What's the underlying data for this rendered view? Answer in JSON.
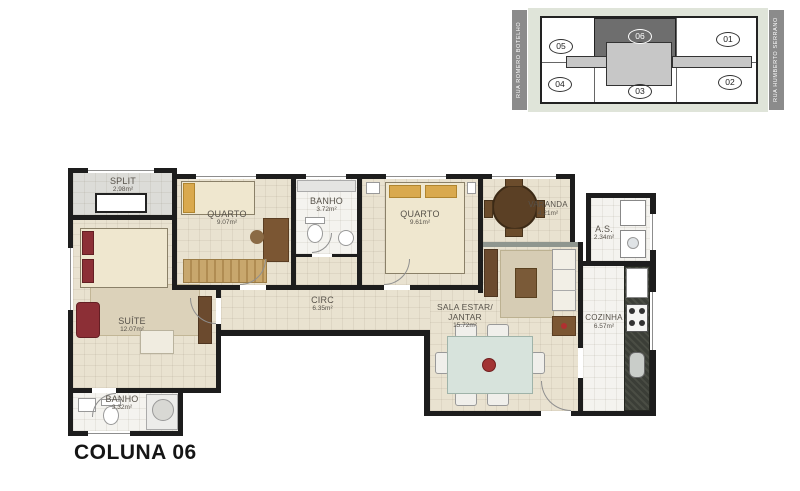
{
  "title": "COLUNA 06",
  "keyplan": {
    "street_left": "RUA ROMERO BOTELHO",
    "street_right": "RUA HUMBERTO SERRANO",
    "highlighted_unit": "06",
    "units": [
      {
        "id": "05"
      },
      {
        "id": "06"
      },
      {
        "id": "01"
      },
      {
        "id": "04"
      },
      {
        "id": "03"
      },
      {
        "id": "02"
      }
    ]
  },
  "rooms": {
    "split": {
      "name": "SPLIT",
      "area": "2.98m²"
    },
    "quarto1": {
      "name": "QUARTO",
      "area": "9.07m²"
    },
    "banho1": {
      "name": "BANHO",
      "area": "3.72m²"
    },
    "quarto2": {
      "name": "QUARTO",
      "area": "9.61m²"
    },
    "varanda": {
      "name": "VARANDA",
      "area": "4,21m²"
    },
    "as": {
      "name": "A.S.",
      "area": "2.34m²"
    },
    "suite": {
      "name": "SUÍTE",
      "area": "12.07m²"
    },
    "circ": {
      "name": "CIRC",
      "area": "6.35m²"
    },
    "sala": {
      "name": "SALA ESTAR/",
      "name2": "JANTAR",
      "area": "15.72m²"
    },
    "cozinha": {
      "name": "COZINHA",
      "area": "6.57m²"
    },
    "banho2": {
      "name": "BANHO",
      "area": "3.32m²"
    }
  },
  "colors": {
    "wall": "#1d1d1d",
    "floor": "#e9e2d0",
    "wet_floor": "#f4f3ef",
    "keyplan_highlight": "#6e6e6e",
    "street_bar": "#8b8b8b"
  }
}
